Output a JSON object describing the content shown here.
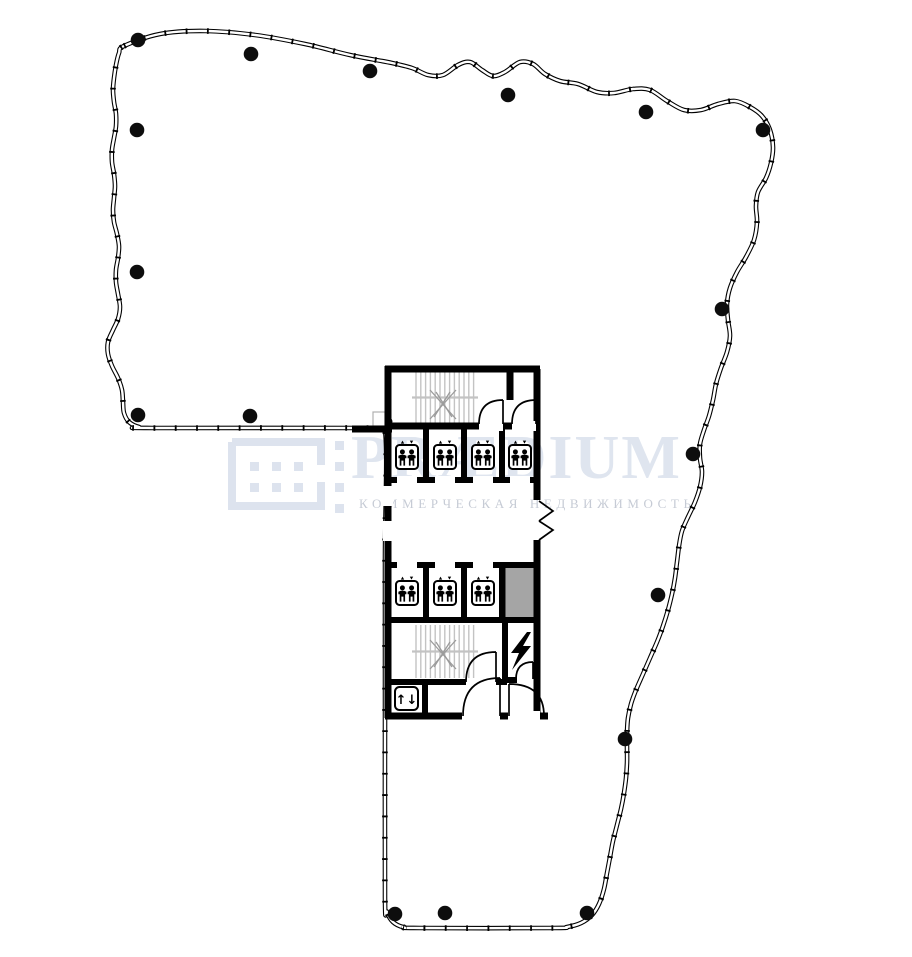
{
  "watermark": {
    "title": "PRÆDIUM",
    "subtitle": "КОММЕРЧЕСКАЯ НЕДВИЖИМОСТЬ"
  },
  "plan": {
    "service_elevator_glyph": "↑↓",
    "upper_elevator_count": 4,
    "lower_elevator_count": 3,
    "stairwell_count": 2,
    "column_count": 17
  },
  "colors": {
    "wall": "#000000",
    "stair-line": "#c3c3c3",
    "stair-mark": "#9b9b9b",
    "shaft-fill": "#a5a5a5",
    "column": "#0d0d0d",
    "watermark-logo": "#dde3ee",
    "watermark-title": "#dfe5ef",
    "watermark-subtitle": "#c6cbd5"
  }
}
